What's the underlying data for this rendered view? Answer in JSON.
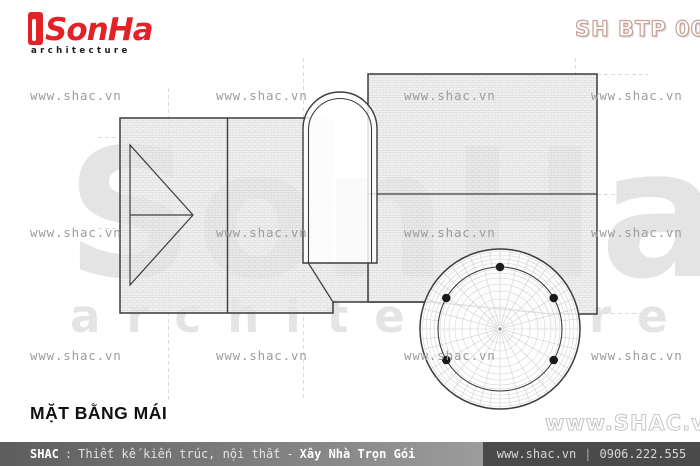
{
  "header": {
    "logo_brand": "SonHa",
    "logo_sub": "architecture",
    "doc_code": "SH BTP 0038"
  },
  "watermark": {
    "tile": "www.shac.vn",
    "corner": "www.SHAC.vn",
    "giant_brand": "SonHa",
    "giant_sub": "architecture"
  },
  "drawing_title": "MẶT BẰNG MÁI",
  "footer": {
    "brand": "SHAC",
    "separator": ":",
    "services": "Thiết kế kiến trúc, nội thất",
    "dash": "-",
    "highlight": "Xây Nhà Trọn Gói",
    "website": "www.shac.vn",
    "pipe": "|",
    "phone": "0906.222.555"
  },
  "colors": {
    "brand_red": "#e32227",
    "line_dark": "#3c3c3c",
    "watermark_gray": "#9c9c9c",
    "footer_dark": "#4a4a4a",
    "footer_mid": "#8a8a8a"
  }
}
